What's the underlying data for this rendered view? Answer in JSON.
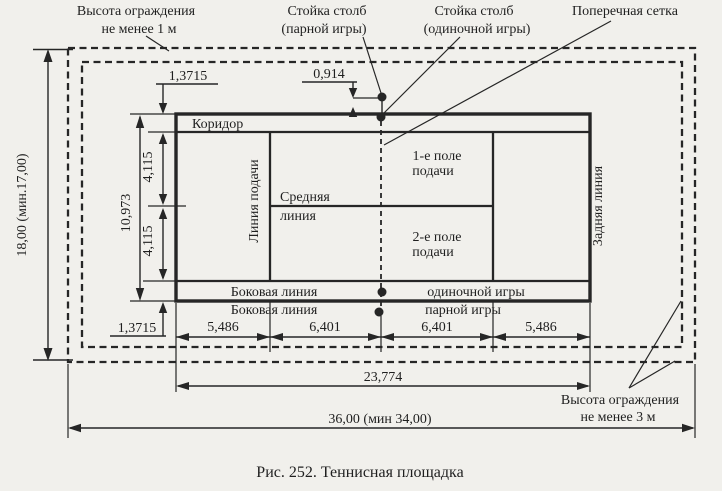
{
  "figure": {
    "caption": "Рис. 252. Теннисная площадка"
  },
  "callouts": {
    "fence_top_1": "Высота ограждения",
    "fence_top_2": "не менее 1 м",
    "post_pair_1": "Стойка столб",
    "post_pair_2": "(парной игры)",
    "post_single_1": "Стойка столб",
    "post_single_2": "(одиночной игры)",
    "net": "Поперечная сетка",
    "fence_bottom_1": "Высота ограждения",
    "fence_bottom_2": "не менее 3 м"
  },
  "court": {
    "corridor": "Коридор",
    "service_line": "Линия подачи",
    "center_1": "Средняя",
    "center_2": "линия",
    "serve1_1": "1-е поле",
    "serve1_2": "подачи",
    "serve2_1": "2-е поле",
    "serve2_2": "подачи",
    "back_line": "Задняя линия",
    "side1_left": "Боковая линия",
    "side1_right": "одиночной игры",
    "side2_left": "Боковая линия",
    "side2_right": "парной игры"
  },
  "dims": {
    "total_h": "18,00 (мин.17,00)",
    "total_w": "36,00 (мин 34,00)",
    "court_len": "23,774",
    "alley_top": "1,3715",
    "alley_bot": "1,3715",
    "post_off": "0,914",
    "court_w": "10,973",
    "serve_w1": "4,115",
    "serve_w2": "4,115",
    "seg1": "5,486",
    "seg2": "6,401",
    "seg3": "6,401",
    "seg4": "5,486"
  },
  "colors": {
    "paper": "#f1f0ec",
    "ink": "#262626"
  }
}
